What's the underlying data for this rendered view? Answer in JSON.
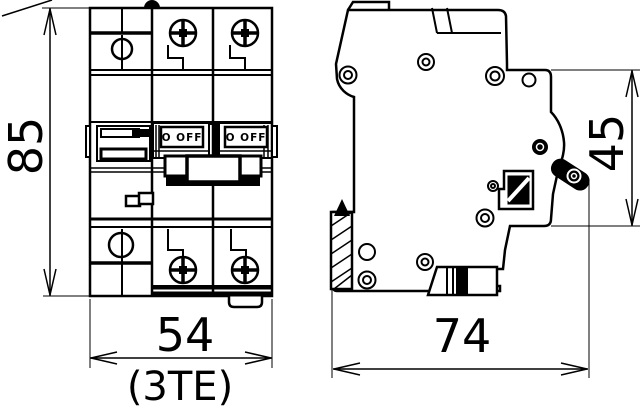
{
  "drawing": {
    "background_color": "#ffffff",
    "line_color": "#000000",
    "front_view": {
      "switches": [
        {
          "label": "O OFF"
        },
        {
          "label": "O OFF"
        }
      ]
    },
    "dimensions": {
      "height_label": "85",
      "width_label": "54",
      "width_note": "(3TE)",
      "depth_label": "74",
      "upper_depth_label": "45"
    }
  }
}
